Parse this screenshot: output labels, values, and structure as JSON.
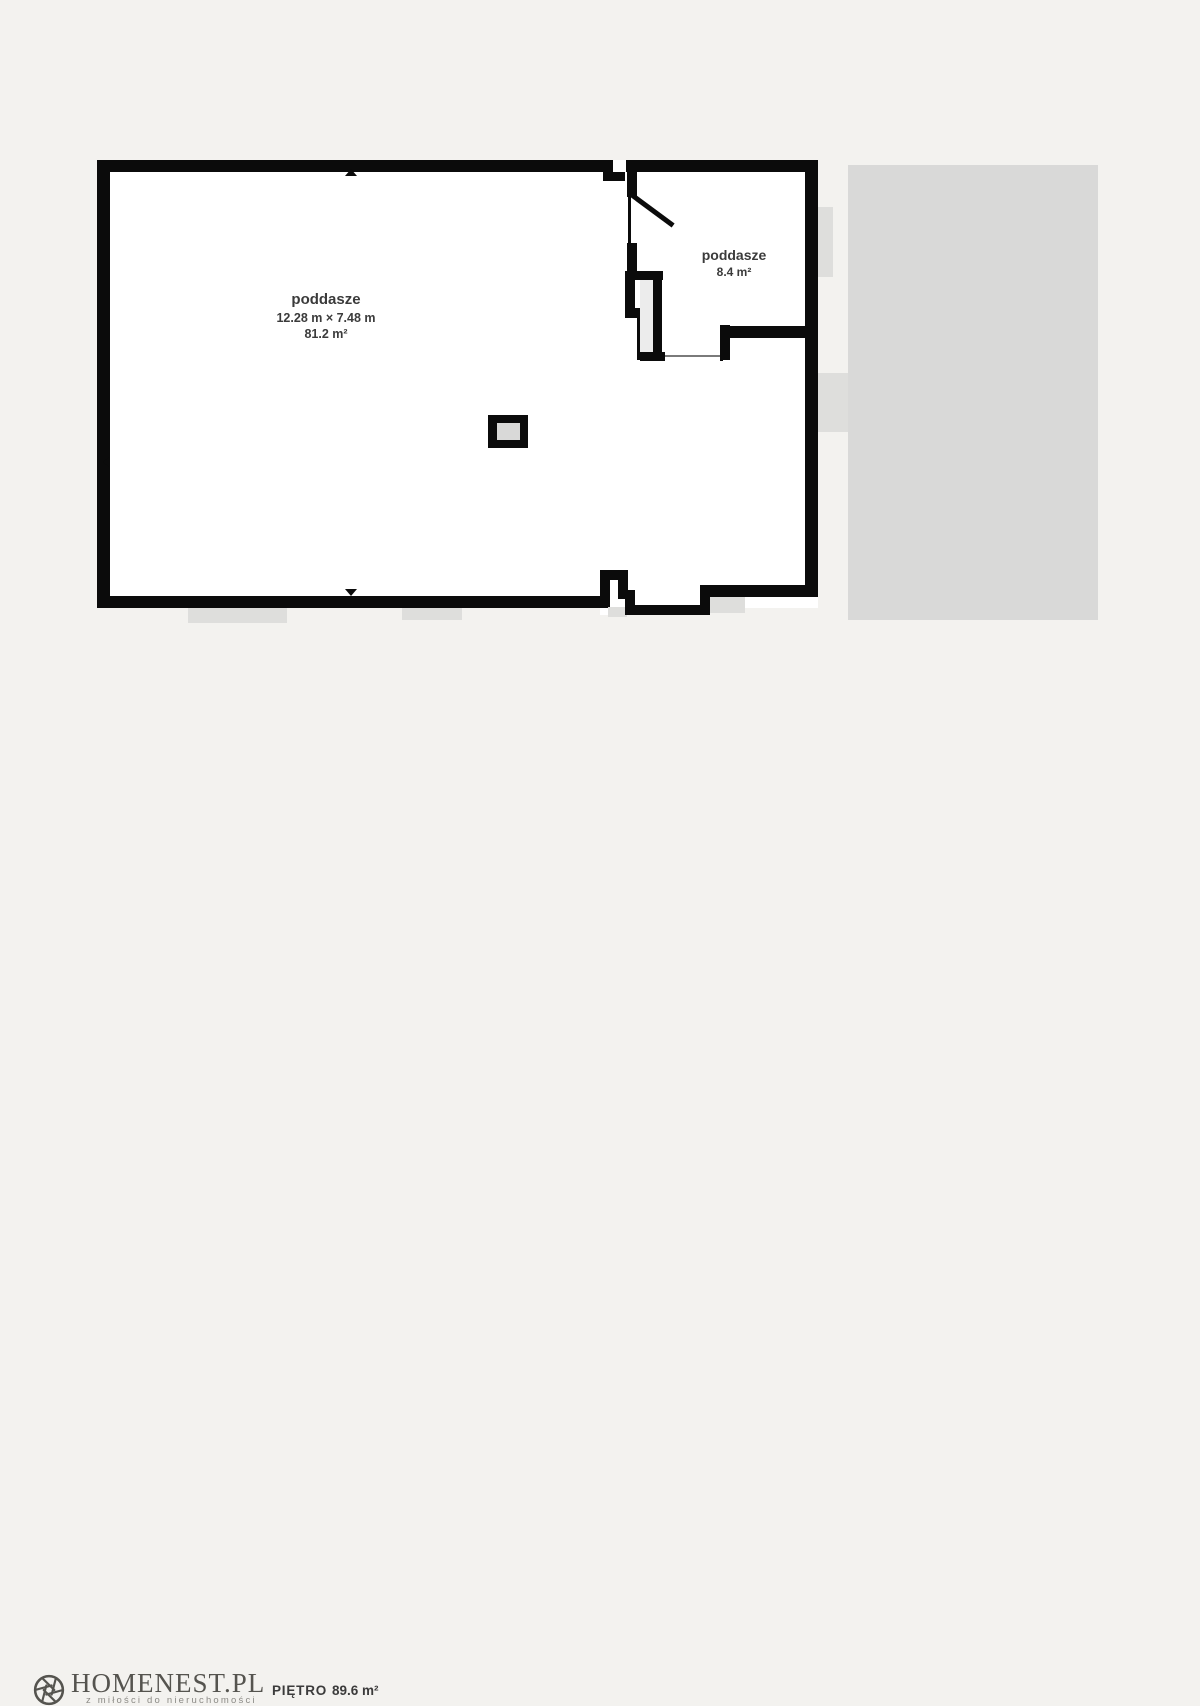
{
  "colors": {
    "background": "#f3f2ef",
    "wall": "#0b0b0b",
    "floor": "#ffffff",
    "exterior_gray": "#dededc",
    "adjacent_roof_gray": "#d9d9d8",
    "label_text": "#3b3b3b",
    "brand_text": "#55544f"
  },
  "plan": {
    "rooms": [
      {
        "name": "poddasze",
        "dimensions": "12.28 m × 7.48 m",
        "area": "81.2 m²"
      },
      {
        "name": "poddasze",
        "area": "8.4 m²"
      }
    ]
  },
  "footer": {
    "brand": "HOMENEST.PL",
    "tagline": "z miłości do nieruchomości",
    "floor_label": "PIĘTRO",
    "floor_area": "89.6 m²"
  }
}
